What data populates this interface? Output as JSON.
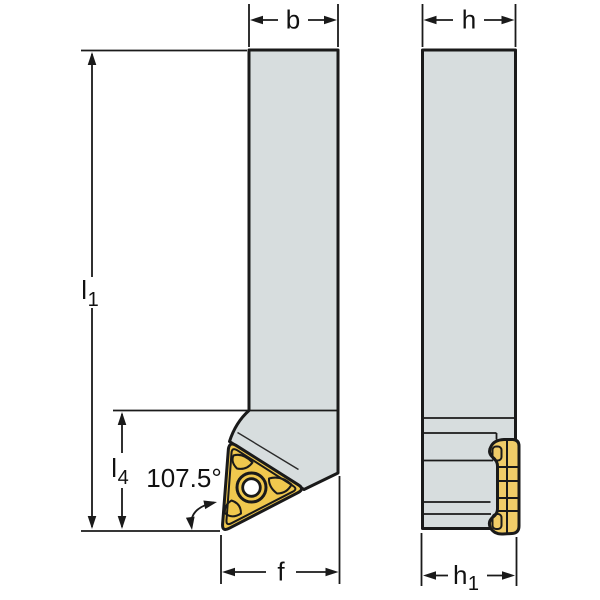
{
  "drawing": {
    "labels": {
      "width_b": "b",
      "height_h": "h",
      "length_l1_base": "l",
      "length_l1_sub": "1",
      "length_l4_base": "l",
      "length_l4_sub": "4",
      "angle": "107.5°",
      "offset_f": "f",
      "height_h1_base": "h",
      "height_h1_sub": "1"
    },
    "colors": {
      "background": "#FFFFFF",
      "body_fill": "#D7DDDE",
      "insert_fill": "#F0C84E",
      "insert_fill_side": "#F0CC68",
      "line": "#1A1A1A"
    }
  }
}
